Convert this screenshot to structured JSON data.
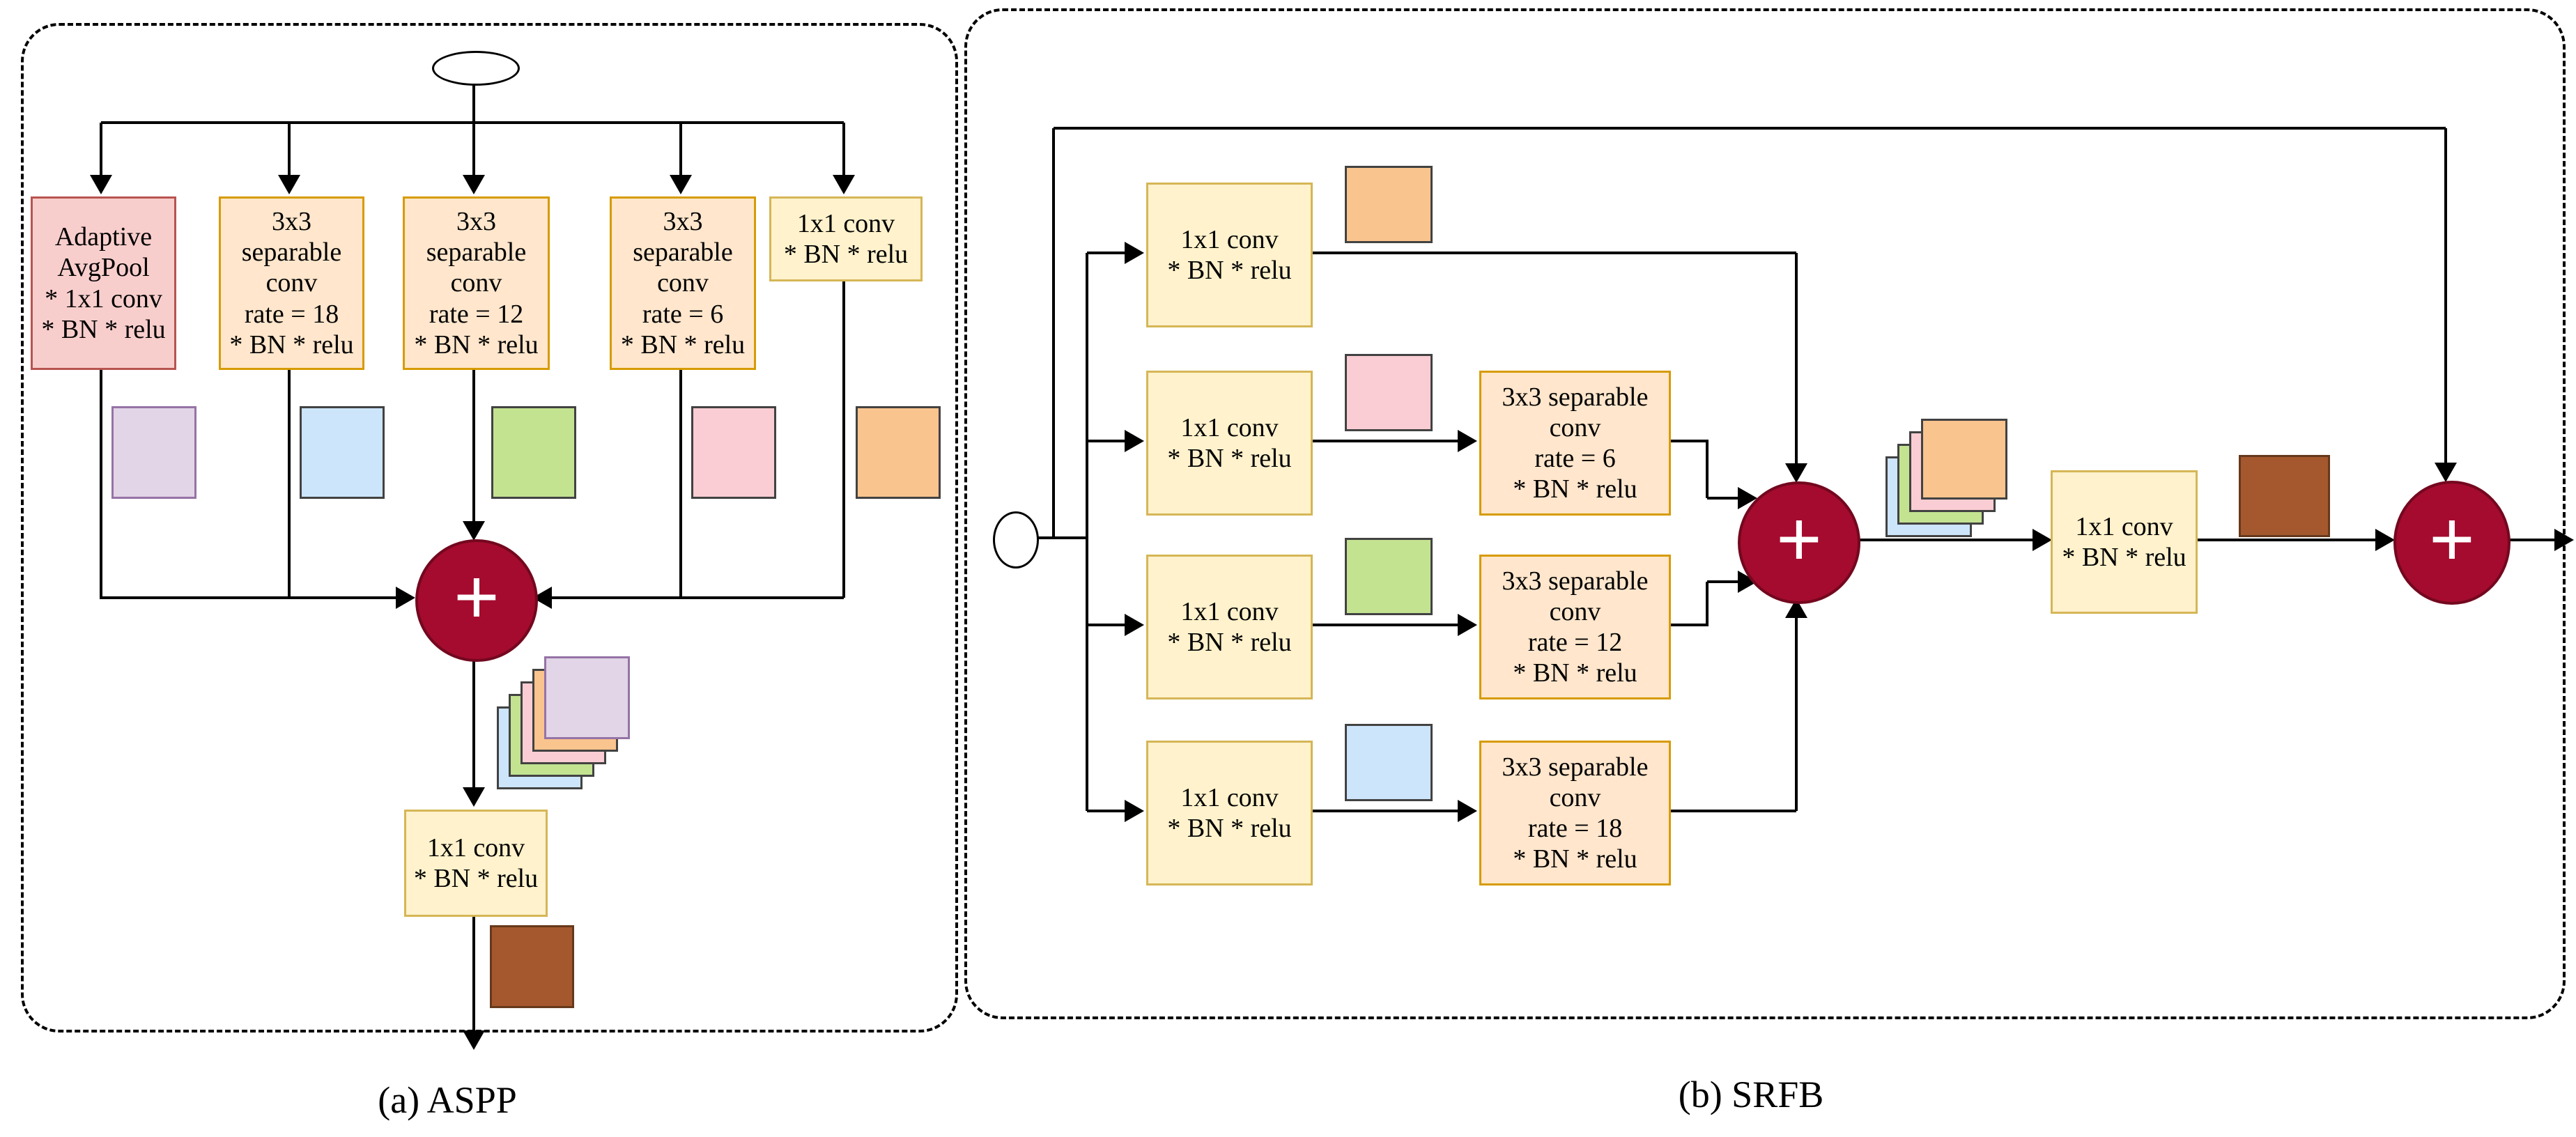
{
  "aspp": {
    "caption": "(a) ASPP",
    "plus_symbol": "+",
    "branch_boxes": [
      {
        "lines": [
          "Adaptive",
          "AvgPool",
          "* 1x1 conv",
          "* BN * relu"
        ]
      },
      {
        "lines": [
          "3x3",
          "separable",
          "conv",
          "rate = 18",
          "* BN * relu"
        ]
      },
      {
        "lines": [
          "3x3",
          "separable",
          "conv",
          "rate = 12",
          "* BN * relu"
        ]
      },
      {
        "lines": [
          "3x3",
          "separable",
          "conv",
          "rate = 6",
          "* BN * relu"
        ]
      },
      {
        "lines": [
          "1x1 conv",
          "* BN * relu"
        ]
      }
    ],
    "output_box": {
      "lines": [
        "1x1 conv",
        "* BN * relu"
      ]
    }
  },
  "srfb": {
    "caption": "(b) SRFB",
    "plus_symbol": "+",
    "reduce_boxes": [
      {
        "lines": [
          "1x1 conv",
          "* BN * relu"
        ]
      },
      {
        "lines": [
          "1x1 conv",
          "* BN * relu"
        ]
      },
      {
        "lines": [
          "1x1 conv",
          "* BN * relu"
        ]
      },
      {
        "lines": [
          "1x1 conv",
          "* BN * relu"
        ]
      }
    ],
    "dilated_boxes": [
      {
        "lines": [
          "3x3 separable",
          "conv",
          "rate = 6",
          "* BN * relu"
        ]
      },
      {
        "lines": [
          "3x3 separable",
          "conv",
          "rate = 12",
          "* BN * relu"
        ]
      },
      {
        "lines": [
          "3x3 separable",
          "conv",
          "rate = 18",
          "* BN * relu"
        ]
      }
    ],
    "projection_box": {
      "lines": [
        "1x1 conv",
        "* BN * relu"
      ]
    }
  },
  "palette": {
    "box_yellow_fill": "#FFF2CC",
    "box_yellow_stroke": "#D6B656",
    "box_orange_fill": "#FFE6CC",
    "box_orange_stroke": "#D79B00",
    "box_red_fill": "#F8CECC",
    "box_red_stroke": "#B85450",
    "map_purple": "#E1D5E7",
    "map_blue": "#CCE5FA",
    "map_green": "#C3E391",
    "map_pink": "#F9CDD3",
    "map_orange": "#FAC48E",
    "map_brown": "#A5582E",
    "add_node_fill": "#A50B2E",
    "wire": "#000000"
  }
}
